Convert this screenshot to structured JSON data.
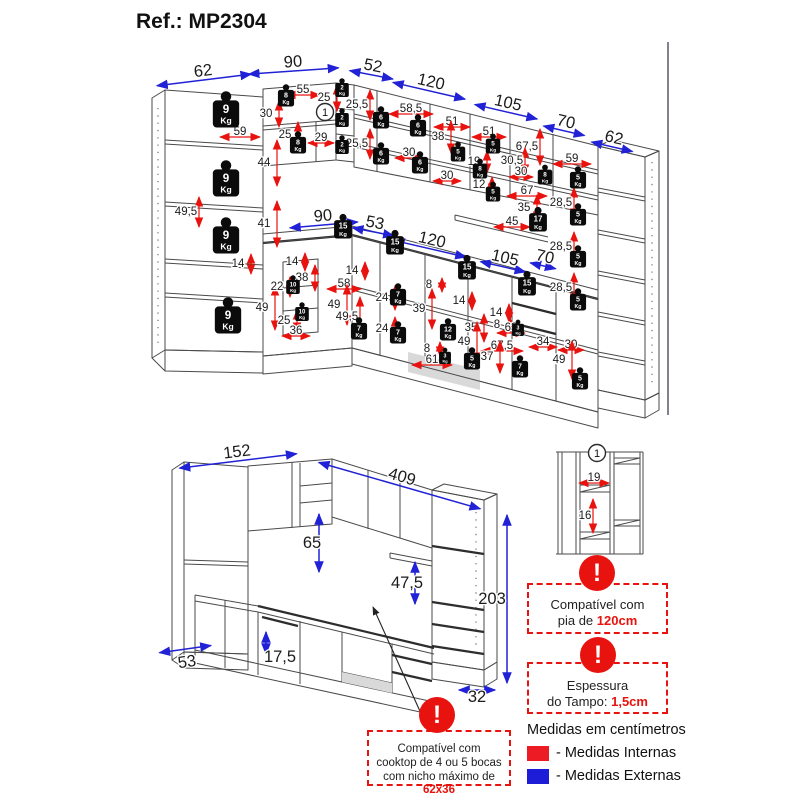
{
  "title": "Ref.: MP2304",
  "icons": {
    "warning_glyph": "!"
  },
  "top_view": {
    "blue_dims": [
      {
        "t": "62",
        "x": 203,
        "y": 71,
        "r": -7,
        "al": 95
      },
      {
        "t": "90",
        "x": 293,
        "y": 62,
        "r": -4,
        "al": 90
      },
      {
        "t": "52",
        "x": 373,
        "y": 66,
        "r": 11,
        "al": 44
      },
      {
        "t": "120",
        "x": 431,
        "y": 82,
        "r": 13,
        "al": 74
      },
      {
        "t": "105",
        "x": 508,
        "y": 103,
        "r": 13,
        "al": 64
      },
      {
        "t": "70",
        "x": 566,
        "y": 122,
        "r": 13,
        "al": 42
      },
      {
        "t": "62",
        "x": 614,
        "y": 138,
        "r": 13,
        "al": 42
      },
      {
        "t": "90",
        "x": 323,
        "y": 216,
        "r": -5,
        "al": 68
      },
      {
        "t": "53",
        "x": 375,
        "y": 223,
        "r": 11,
        "al": 42
      },
      {
        "t": "120",
        "x": 432,
        "y": 240,
        "r": 13,
        "al": 74
      },
      {
        "t": "105",
        "x": 505,
        "y": 258,
        "r": 13,
        "al": 46
      },
      {
        "t": "70",
        "x": 545,
        "y": 257,
        "r": 13,
        "al": 26
      }
    ],
    "red_dims": [
      {
        "t": "59",
        "x": 240,
        "y": 131,
        "d": "h",
        "al": 40
      },
      {
        "t": "30",
        "x": 266,
        "y": 113,
        "d": "v"
      },
      {
        "t": "55",
        "x": 303,
        "y": 89,
        "d": "h",
        "al": 34
      },
      {
        "t": "25",
        "x": 324,
        "y": 97,
        "d": "v"
      },
      {
        "t": "25",
        "x": 285,
        "y": 134,
        "d": "v"
      },
      {
        "t": "29",
        "x": 321,
        "y": 137,
        "d": "h",
        "al": 26
      },
      {
        "t": "44",
        "x": 264,
        "y": 162,
        "d": "v",
        "al": 46
      },
      {
        "t": "41",
        "x": 264,
        "y": 223,
        "d": "v",
        "al": 46
      },
      {
        "t": "49,5",
        "x": 186,
        "y": 211,
        "d": "v",
        "al": 30
      },
      {
        "t": "14",
        "x": 238,
        "y": 263,
        "d": "v",
        "al": 20
      },
      {
        "t": "49",
        "x": 262,
        "y": 307,
        "d": "v",
        "al": 44
      },
      {
        "t": "25",
        "x": 284,
        "y": 320,
        "d": "v",
        "al": 22
      },
      {
        "t": "36",
        "x": 296,
        "y": 330,
        "d": "h",
        "al": 28
      },
      {
        "t": "22",
        "x": 277,
        "y": 286,
        "d": "v",
        "al": 20
      },
      {
        "t": "38",
        "x": 302,
        "y": 277,
        "d": "v",
        "al": 26
      },
      {
        "t": "14",
        "x": 292,
        "y": 261,
        "d": "v",
        "al": 18
      },
      {
        "t": "25,5",
        "x": 357,
        "y": 104,
        "d": "v",
        "al": 30
      },
      {
        "t": "25,5",
        "x": 357,
        "y": 143,
        "d": "v",
        "al": 30
      },
      {
        "t": "58,5",
        "x": 411,
        "y": 108,
        "d": "h",
        "al": 44
      },
      {
        "t": "51",
        "x": 452,
        "y": 121,
        "d": "h",
        "al": 36
      },
      {
        "t": "38",
        "x": 438,
        "y": 136,
        "d": "v",
        "al": 32
      },
      {
        "t": "30",
        "x": 409,
        "y": 152,
        "d": "h",
        "al": 28
      },
      {
        "t": "30",
        "x": 447,
        "y": 175,
        "d": "h",
        "al": 28
      },
      {
        "t": "51",
        "x": 489,
        "y": 131,
        "d": "h",
        "al": 34
      },
      {
        "t": "67,5",
        "x": 527,
        "y": 146,
        "d": "v",
        "al": 36
      },
      {
        "t": "19",
        "x": 474,
        "y": 161,
        "d": "v",
        "al": 22
      },
      {
        "t": "30,5",
        "x": 512,
        "y": 160,
        "d": "v",
        "al": 26
      },
      {
        "t": "30",
        "x": 521,
        "y": 171,
        "d": "h",
        "al": 24
      },
      {
        "t": "12",
        "x": 479,
        "y": 184,
        "d": "v",
        "al": 16
      },
      {
        "t": "67",
        "x": 527,
        "y": 190,
        "d": "h",
        "al": 40
      },
      {
        "t": "35",
        "x": 524,
        "y": 207,
        "d": "v",
        "al": 26
      },
      {
        "t": "45",
        "x": 512,
        "y": 221,
        "d": "h",
        "al": 36
      },
      {
        "t": "59",
        "x": 572,
        "y": 158,
        "d": "h",
        "al": 38
      },
      {
        "t": "28,5",
        "x": 561,
        "y": 202,
        "d": "v",
        "al": 30
      },
      {
        "t": "28,5",
        "x": 561,
        "y": 246,
        "d": "v",
        "al": 30
      },
      {
        "t": "28,5",
        "x": 561,
        "y": 287,
        "d": "v",
        "al": 30
      },
      {
        "t": "14",
        "x": 352,
        "y": 270,
        "d": "v",
        "al": 18
      },
      {
        "t": "58",
        "x": 344,
        "y": 283,
        "d": "h",
        "al": 34
      },
      {
        "t": "49",
        "x": 334,
        "y": 304,
        "d": "v",
        "al": 40
      },
      {
        "t": "49,5",
        "x": 347,
        "y": 316,
        "d": "v",
        "al": 40
      },
      {
        "t": "24",
        "x": 382,
        "y": 297,
        "d": "v",
        "al": 24
      },
      {
        "t": "24",
        "x": 382,
        "y": 328,
        "d": "v",
        "al": 24
      },
      {
        "t": "8",
        "x": 429,
        "y": 284,
        "d": "v",
        "al": 14
      },
      {
        "t": "39",
        "x": 419,
        "y": 308,
        "d": "v",
        "al": 40
      },
      {
        "t": "14",
        "x": 459,
        "y": 300,
        "d": "v",
        "al": 18
      },
      {
        "t": "35",
        "x": 471,
        "y": 327,
        "d": "v",
        "al": 28
      },
      {
        "t": "49",
        "x": 464,
        "y": 341,
        "d": "v",
        "al": 40
      },
      {
        "t": "8",
        "x": 427,
        "y": 348,
        "d": "v",
        "al": 14
      },
      {
        "t": "61",
        "x": 432,
        "y": 359,
        "d": "h",
        "al": 40
      },
      {
        "t": "14",
        "x": 496,
        "y": 312,
        "d": "v",
        "al": 18
      },
      {
        "t": "8",
        "x": 497,
        "y": 324,
        "d": "v",
        "al": 14
      },
      {
        "t": "63",
        "x": 511,
        "y": 327,
        "d": "h",
        "al": 28
      },
      {
        "t": "67,5",
        "x": 502,
        "y": 345,
        "d": "h",
        "al": 42
      },
      {
        "t": "37",
        "x": 487,
        "y": 356,
        "d": "v",
        "al": 32
      },
      {
        "t": "34",
        "x": 543,
        "y": 341,
        "d": "h",
        "al": 28
      },
      {
        "t": "30",
        "x": 571,
        "y": 344,
        "d": "h",
        "al": 26
      },
      {
        "t": "49",
        "x": 559,
        "y": 359,
        "d": "v",
        "al": 38
      }
    ],
    "weights": [
      {
        "kg": "9",
        "x": 226,
        "y": 112,
        "s": 1.55
      },
      {
        "kg": "9",
        "x": 226,
        "y": 181,
        "s": 1.55
      },
      {
        "kg": "9",
        "x": 226,
        "y": 238,
        "s": 1.55
      },
      {
        "kg": "9",
        "x": 228,
        "y": 318,
        "s": 1.55
      },
      {
        "kg": "8",
        "x": 286,
        "y": 97,
        "s": 0.95
      },
      {
        "kg": "8",
        "x": 298,
        "y": 144,
        "s": 0.95
      },
      {
        "kg": "2",
        "x": 342,
        "y": 89,
        "s": 0.8
      },
      {
        "kg": "2",
        "x": 342,
        "y": 119,
        "s": 0.8
      },
      {
        "kg": "2",
        "x": 342,
        "y": 146,
        "s": 0.8
      },
      {
        "kg": "6",
        "x": 381,
        "y": 119,
        "s": 0.95
      },
      {
        "kg": "6",
        "x": 418,
        "y": 127,
        "s": 0.95
      },
      {
        "kg": "6",
        "x": 381,
        "y": 155,
        "s": 0.95
      },
      {
        "kg": "6",
        "x": 420,
        "y": 164,
        "s": 0.95
      },
      {
        "kg": "5",
        "x": 458,
        "y": 153,
        "s": 0.85
      },
      {
        "kg": "5",
        "x": 493,
        "y": 145,
        "s": 0.85
      },
      {
        "kg": "5",
        "x": 493,
        "y": 193,
        "s": 0.85
      },
      {
        "kg": "8",
        "x": 480,
        "y": 170,
        "s": 0.85
      },
      {
        "kg": "8",
        "x": 545,
        "y": 176,
        "s": 0.85
      },
      {
        "kg": "17",
        "x": 538,
        "y": 221,
        "s": 1.05
      },
      {
        "kg": "15",
        "x": 343,
        "y": 228,
        "s": 1.05
      },
      {
        "kg": "15",
        "x": 395,
        "y": 244,
        "s": 1.05
      },
      {
        "kg": "15",
        "x": 467,
        "y": 269,
        "s": 1.05
      },
      {
        "kg": "15",
        "x": 527,
        "y": 285,
        "s": 1.05
      },
      {
        "kg": "5",
        "x": 578,
        "y": 179,
        "s": 0.95
      },
      {
        "kg": "5",
        "x": 578,
        "y": 216,
        "s": 0.95
      },
      {
        "kg": "5",
        "x": 578,
        "y": 258,
        "s": 0.95
      },
      {
        "kg": "5",
        "x": 578,
        "y": 301,
        "s": 0.95
      },
      {
        "kg": "5",
        "x": 580,
        "y": 380,
        "s": 0.95
      },
      {
        "kg": "10",
        "x": 293,
        "y": 286,
        "s": 0.8
      },
      {
        "kg": "10",
        "x": 302,
        "y": 313,
        "s": 0.8
      },
      {
        "kg": "7",
        "x": 359,
        "y": 330,
        "s": 0.95
      },
      {
        "kg": "7",
        "x": 398,
        "y": 296,
        "s": 0.95
      },
      {
        "kg": "7",
        "x": 398,
        "y": 334,
        "s": 0.95
      },
      {
        "kg": "7",
        "x": 520,
        "y": 368,
        "s": 0.95
      },
      {
        "kg": "12",
        "x": 448,
        "y": 331,
        "s": 0.95
      },
      {
        "kg": "5",
        "x": 472,
        "y": 360,
        "s": 0.95
      },
      {
        "kg": "3",
        "x": 445,
        "y": 357,
        "s": 0.7
      },
      {
        "kg": "3",
        "x": 518,
        "y": 329,
        "s": 0.7
      }
    ]
  },
  "overall_view": {
    "blue_dims": [
      {
        "t": "152",
        "x": 237,
        "y": 452,
        "r": -7,
        "ad": "h",
        "al": 118,
        "aoy": 9
      },
      {
        "t": "409",
        "x": 402,
        "y": 477,
        "r": 16,
        "ad": "h",
        "al": 168,
        "aoy": 9
      },
      {
        "t": "65",
        "x": 312,
        "y": 543,
        "ad": "v",
        "al": 58,
        "aox": 7,
        "aoy": 0
      },
      {
        "t": "47,5",
        "x": 407,
        "y": 583,
        "ad": "v",
        "al": 42,
        "aox": 8,
        "aoy": 0
      },
      {
        "t": "203",
        "x": 492,
        "y": 599,
        "ad": "v",
        "al": 168,
        "aox": 15,
        "aoy": 0
      },
      {
        "t": "53",
        "x": 187,
        "y": 662,
        "r": -8,
        "ad": "h",
        "al": 52,
        "aoy": -13
      },
      {
        "t": "17,5",
        "x": 280,
        "y": 657,
        "ad": "v",
        "al": 22,
        "aox": -14,
        "aoy": -14
      },
      {
        "t": "32",
        "x": 477,
        "y": 697,
        "ad": "h",
        "al": 36,
        "aoy": -7
      }
    ]
  },
  "detail_view": {
    "red_dims": [
      {
        "t": "19",
        "x": 594,
        "y": 477,
        "d": "h",
        "al": 30
      },
      {
        "t": "16",
        "x": 585,
        "y": 515,
        "d": "v",
        "al": 34,
        "aox": 8
      }
    ]
  },
  "markers": [
    {
      "t": "1",
      "x": 325,
      "y": 112
    },
    {
      "t": "1",
      "x": 597,
      "y": 453
    }
  ],
  "notes": {
    "sink": {
      "line1": "Compatível com",
      "line2_pre": "pia de ",
      "line2_red": "120cm"
    },
    "countertop": {
      "line1": "Espessura",
      "line2_pre": "do Tampo: ",
      "line2_red": "1,5cm"
    },
    "cooktop": {
      "line1": "Compatível com",
      "line2": "cooktop de 4 ou 5 bocas",
      "line3_pre": "com nicho máximo de ",
      "line3_red": "62x36"
    }
  },
  "legend": {
    "units_label": "Medidas em centímetros",
    "internal_label": "- Medidas Internas",
    "external_label": "- Medidas Externas",
    "internal_color": "#ed1c24",
    "external_color": "#1d1dd8"
  }
}
